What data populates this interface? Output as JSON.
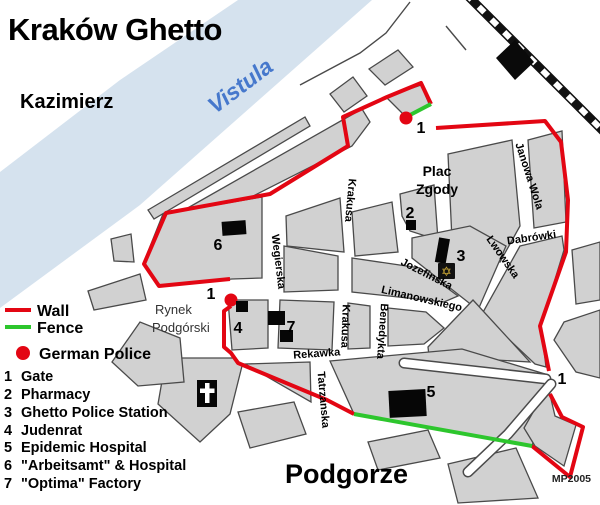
{
  "title": "Kraków Ghetto",
  "regions": {
    "kazimierz": "Kazimierz",
    "river": "Vistula",
    "plac_zgody_line1": "Plac",
    "plac_zgody_line2": "Zgody",
    "rynek_line1": "Rynek",
    "rynek_line2": "Podgórski",
    "podgorze": "Podgorze"
  },
  "credit": "MP2005",
  "streets": {
    "wegierska": "Wegierska",
    "krakusa_upper": "Krakusa",
    "krakusa_lower": "Krakusa",
    "jozefinska": "Jozefinska",
    "limanowskiego": "Limanowskiego",
    "benedykta": "Benedykta",
    "rekawka": "Rekawka",
    "tatrzanska": "Tatrzanska",
    "lwowska": "Lwowska",
    "dabrowki": "Dabrówki",
    "janowa_wola": "Janowa Wola"
  },
  "markers": {
    "gate_top": "1",
    "gate_west": "1",
    "gate_east": "1",
    "pharmacy": "2",
    "police_station": "3",
    "judenrat": "4",
    "epidemic_hospital": "5",
    "arbeitsamt": "6",
    "optima": "7"
  },
  "icons": {
    "star_of_david": "✡"
  },
  "legend": {
    "wall_label": "Wall",
    "fence_label": "Fence",
    "police_label": "German Police",
    "items": [
      {
        "num": "1",
        "label": "Gate"
      },
      {
        "num": "2",
        "label": "Pharmacy"
      },
      {
        "num": "3",
        "label": "Ghetto Police Station"
      },
      {
        "num": "4",
        "label": "Judenrat"
      },
      {
        "num": "5",
        "label": "Epidemic Hospital"
      },
      {
        "num": "6",
        "label": "\"Arbeitsamt\" & Hospital"
      },
      {
        "num": "7",
        "label": "\"Optima\" Factory"
      }
    ]
  },
  "colors": {
    "wall": "#e30613",
    "fence": "#2dc62d",
    "police_dot": "#e30613",
    "river": "#d5e2ee",
    "block": "#d1d1d1",
    "block_outline": "#4a4a4a",
    "building": "#060606",
    "river_text": "#4678cc",
    "star": "#d4af37"
  }
}
